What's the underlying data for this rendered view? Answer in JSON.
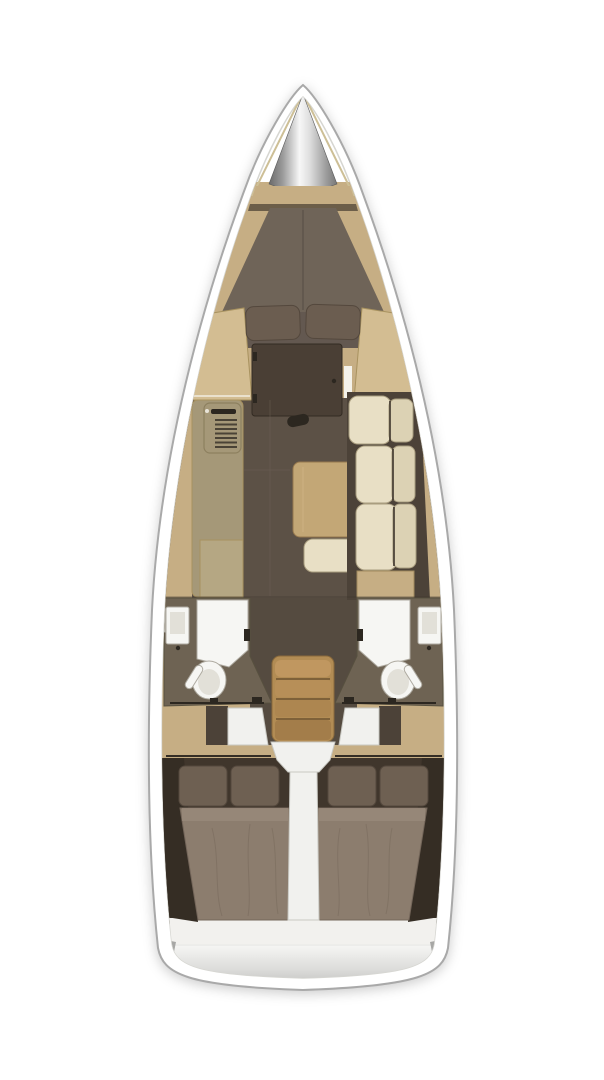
{
  "image": {
    "kind": "yacht-interior-layout-plan",
    "description": "Top-down floor plan of a sailing yacht interior: bow anchor locker, forward V-berth cabin, saloon with galley and starboard settee, twin mid heads with showers and toilets, companionway steps, two aft double cabins, swim-platform transom.",
    "width_px": 604,
    "height_px": 1080
  },
  "regions": {
    "bow": [
      "anchor-locker",
      "bow-shelf"
    ],
    "forward_cabin": [
      "v-berth-bed",
      "pillow-port",
      "pillow-starboard",
      "wardrobe-port",
      "wardrobe-starboard",
      "cabin-door"
    ],
    "saloon": [
      "galley-counter",
      "stove",
      "sink-cabinet",
      "saloon-table",
      "bench-cushion",
      "starboard-settee",
      "deck-hatch-handle"
    ],
    "midship": [
      "port-head",
      "starboard-head",
      "shower",
      "washbasin",
      "toilet",
      "companionway-steps",
      "engine-cover"
    ],
    "aft": [
      "aft-cabin-port",
      "aft-cabin-starboard",
      "double-berth",
      "walkway",
      "transom-swim-platform"
    ]
  },
  "palette": {
    "background": "#ffffff",
    "hull_fill": "#ffffff",
    "hull_outline": "#a9a9a9",
    "deck_line": "#d6d6d1",
    "wood": "#c6ae84",
    "wood_light": "#d3bd92",
    "wood_dark": "#a8925f",
    "galley": "#a59878",
    "galley_light": "#b5a783",
    "floor": "#5c5146",
    "walkway": "#554b40",
    "sofa_base": "#4c4238",
    "cream": "#e8dfc5",
    "cream_dark": "#dcd2b4",
    "cream_stroke": "#a99d7f",
    "table_wood": "#c3a776",
    "table_edge": "#96784e",
    "berth": "#6f6458",
    "berth_foot": "#635850",
    "pillow_fwd": "#6b5d50",
    "pillow_aft": "#6e6052",
    "pillow_edge": "#54483d",
    "duvet": "#8c7d6e",
    "duvet_edge": "#74665a",
    "cabin_dark": "#40362c",
    "cabin_edge": "#352d24",
    "door_brown": "#4a3f35",
    "bath_wall": "#6e6353",
    "bath_wall_dark": "#57503f",
    "fixture": "#f6f6f3",
    "fixture_inner": "#e2e0d8",
    "fixture_stroke": "#aeaaa0",
    "stair_wood": "#b28c54",
    "stair_dark": "#8a6a3c",
    "hardware": "#2c2720",
    "white_molding": "#f1f1ee",
    "foot_white": "#f2f1ee",
    "seam": "#6b6054",
    "metal_edge": "#6a6a6a",
    "metal_mid": "#9a9a9a",
    "metal_hi": "#f7f7f7",
    "transom_top": "#f7f7f5",
    "transom_bottom": "#bcbcba",
    "shadow_gray": "#a7a7a5",
    "transom_edge": "#8d8d8b"
  }
}
